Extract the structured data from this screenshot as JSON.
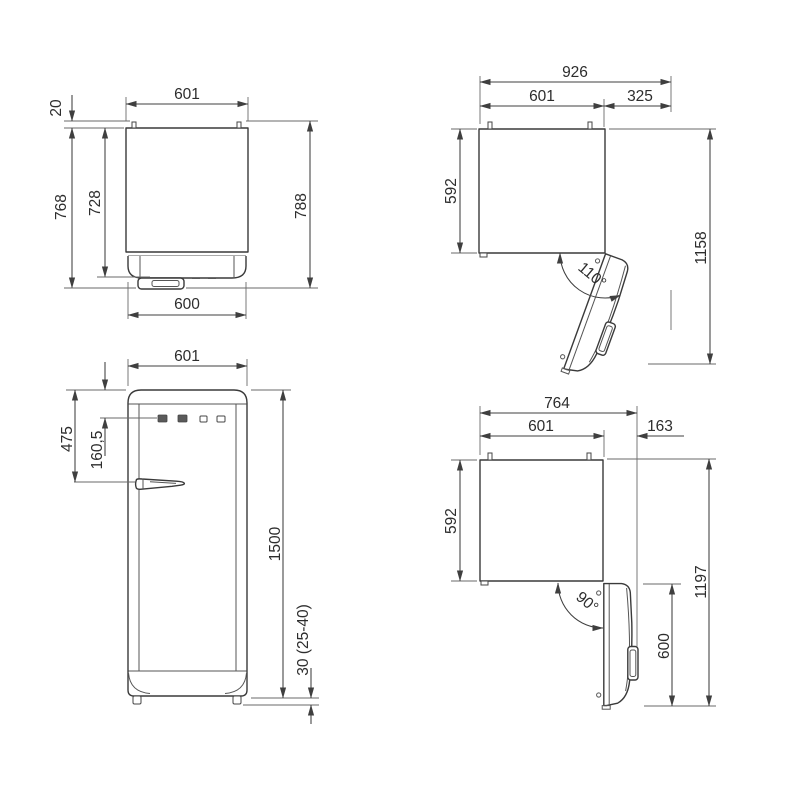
{
  "drawing_type": "refrigerator dimension drawing, four orthographic views",
  "colors": {
    "background": "#ffffff",
    "line": "#3a3a3a",
    "dimension_text": "#2d2d2d"
  },
  "views": {
    "top_closed": {
      "width_top": "601",
      "hinge_protrusion": "20",
      "depth_without_handle": "768",
      "depth_body": "728",
      "depth_overall": "788",
      "width_bottom": "600"
    },
    "top_open_110": {
      "overall_width": "926",
      "cabinet_width": "601",
      "door_projection": "325",
      "cabinet_depth": "592",
      "overall_depth": "1158",
      "opening_angle": "110°"
    },
    "front": {
      "width": "601",
      "top_to_handle": "475",
      "top_to_controls": "160,5",
      "height": "1500",
      "feet_height": "30 (25-40)"
    },
    "top_open_90": {
      "overall_width": "764",
      "cabinet_width": "601",
      "door_projection": "163",
      "cabinet_depth": "592",
      "overall_depth": "1197",
      "door_span": "600",
      "opening_angle": "90°"
    }
  }
}
